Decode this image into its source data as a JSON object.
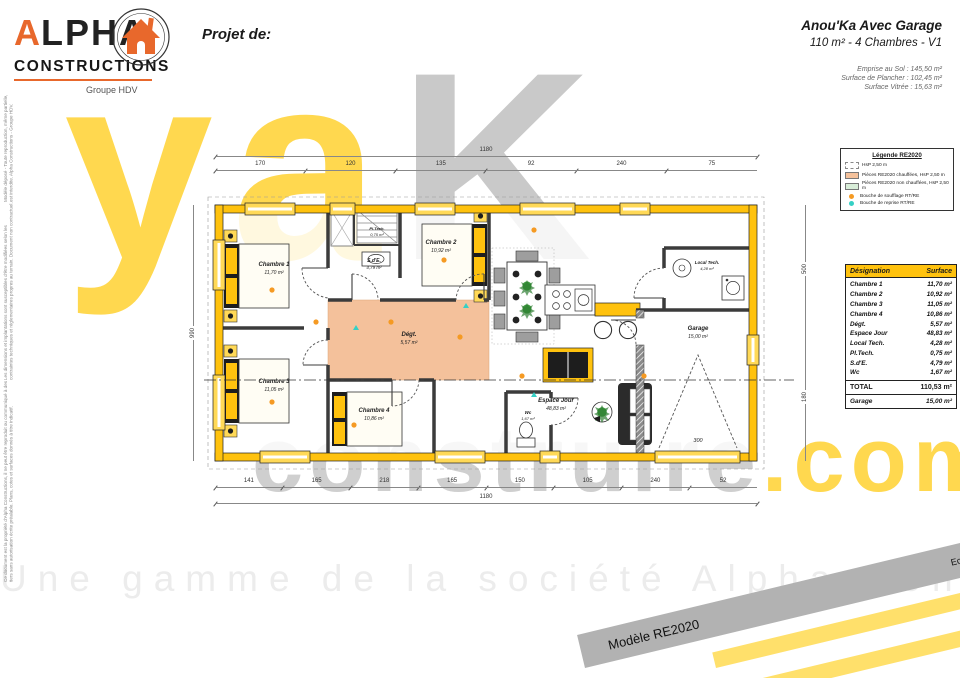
{
  "logo": {
    "brand_a": "A",
    "brand_rest": "LPHA",
    "line2": "CONSTRUCTIONS",
    "group": "Groupe HDV"
  },
  "header": {
    "project_label": "Projet de:",
    "title": "Anou'Ka Avec Garage",
    "subtitle": "110 m² - 4 Chambres - V1",
    "stats": [
      "Emprise au Sol : 145,50 m²",
      "Surface de Plancher : 102,45 m²",
      "Surface Vitrée : 15,63 m²"
    ]
  },
  "legend": {
    "title": "Légende RE2020",
    "items": [
      {
        "label": "HsP 2,50 m"
      },
      {
        "label": "Pièces RE2020 chauffées, HsP 2,50 m"
      },
      {
        "label": "Pièces RE2020 non chauffées, HsP 2,50 m"
      },
      {
        "label": "Bouche de soufflage RT/RE"
      },
      {
        "label": "Bouche de reprise RT/RE"
      }
    ]
  },
  "surface_table": {
    "headers": [
      "Désignation",
      "Surface"
    ],
    "rows": [
      [
        "Chambre 1",
        "11,70 m²"
      ],
      [
        "Chambre 2",
        "10,92 m²"
      ],
      [
        "Chambre 3",
        "11,05 m²"
      ],
      [
        "Chambre 4",
        "10,86 m²"
      ],
      [
        "Dégt.",
        "5,57 m²"
      ],
      [
        "Espace Jour",
        "48,83 m²"
      ],
      [
        "Local Tech.",
        "4,28 m²"
      ],
      [
        "Pl.Tech.",
        "0,75 m²"
      ],
      [
        "S.d'E.",
        "4,79 m²"
      ],
      [
        "Wc",
        "1,67 m²"
      ]
    ],
    "total": {
      "label": "TOTAL",
      "value": "110,53 m²"
    },
    "garage": {
      "label": "Garage",
      "value": "15,00 m²"
    }
  },
  "plan": {
    "rooms": [
      {
        "name": "Chambre 1",
        "area": "11,70 m²"
      },
      {
        "name": "S.d'E.",
        "area": "4,79 m²"
      },
      {
        "name": "Pl.Tech.",
        "area": "0,75 m²"
      },
      {
        "name": "Chambre 2",
        "area": "10,92 m²"
      },
      {
        "name": "Dégt.",
        "area": "5,57 m²"
      },
      {
        "name": "Chambre 3",
        "area": "11,05 m²"
      },
      {
        "name": "Chambre 4",
        "area": "10,86 m²"
      },
      {
        "name": "Wc",
        "area": "1,67 m²"
      },
      {
        "name": "Espace Jour",
        "area": "48,83 m²"
      },
      {
        "name": "Local Tech.",
        "area": "4,28 m²"
      },
      {
        "name": "Garage",
        "area": "15,00 m²"
      }
    ],
    "dims_top": [
      "170",
      "120",
      "135",
      "92",
      "240",
      "75"
    ],
    "dims_top_overall": "1180",
    "dims_bottom": [
      "141",
      "165",
      "218",
      "165",
      "150",
      "105",
      "240",
      "52"
    ],
    "dims_bottom_overall": "1180",
    "dims_left": "990",
    "dims_right": [
      "500",
      "180"
    ],
    "garage_door_width": "300"
  },
  "watermark": {
    "big_left": "ya",
    "big_right": "K",
    "line_gray": "construire",
    "line_yellow": ".com",
    "bottom": "Une gamme de la société Alpha Constructions"
  },
  "banner": {
    "gray_label": "Modèle RE2020",
    "scale": "Echelle 1:75",
    "yellow1": "A_110_4C_G_V1",
    "yellow2": "Version 7.01 - Mars 2023"
  },
  "side_note": {
    "lines": [
      "Ce document est la propriété d'Alpha Constructions, il ne peut être reproduit ou communiqué à des tiers sans autorisation écrite préalable. Plans, cotes et surfaces donnés à titre indicatif.",
      "Les dimensions et implantations sont susceptibles d'être modifiées selon les contraintes techniques et réglementaires propres au terrain. Document non contractuel.",
      "Modèle déposé - Toute reproduction, même partielle, est interdite. Alpha Constructions - Groupe HDV."
    ]
  }
}
